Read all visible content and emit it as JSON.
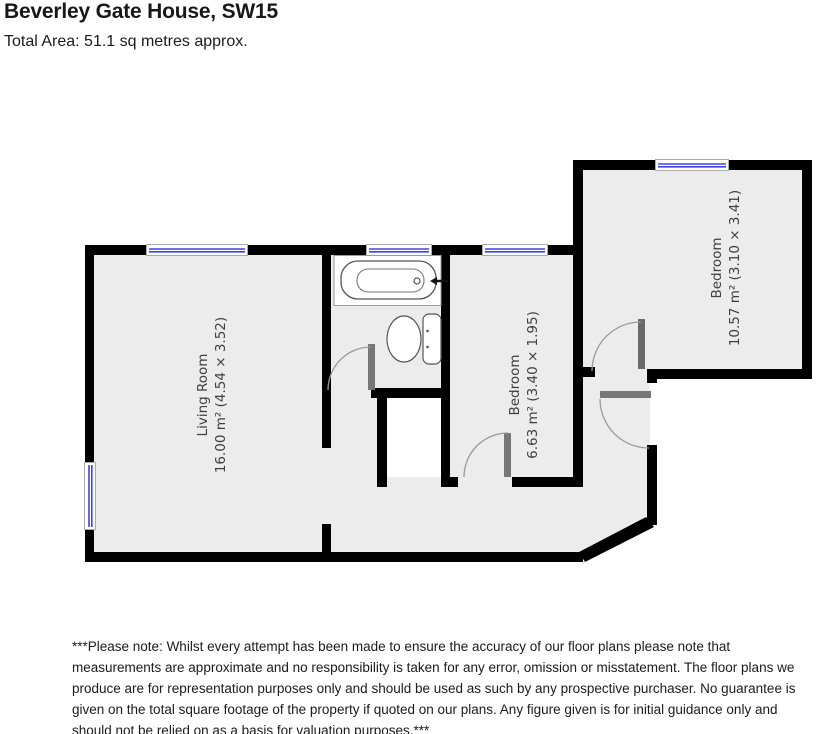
{
  "header": {
    "title": "Beverley Gate House, SW15",
    "subtitle": "Total Area: 51.1 sq metres approx."
  },
  "plan": {
    "rooms": [
      {
        "name": "Living Room",
        "details": "16.00 m² (4.54 × 3.52)"
      },
      {
        "name": "Bedroom",
        "details": "6.63 m² (3.40 × 1.95)"
      },
      {
        "name": "Bedroom",
        "details": "10.57 m² (3.10 × 3.41)"
      }
    ],
    "fixtures": [
      "bathtub",
      "toilet"
    ],
    "colors": {
      "wall": "#000000",
      "floor": "#ececec",
      "window_blue": "#4242e0",
      "door_gray": "#777777"
    }
  },
  "footer": {
    "disclaimer": "***Please note: Whilst every attempt has been made to ensure the accuracy of our floor plans please note that measurements are approximate and no responsibility is taken for any error, omission or misstatement. The floor plans we produce are for representation purposes only and should be used as such by any prospective purchaser. No guarantee is given on the total square footage of the property if quoted on our plans. Any figure given is for initial guidance only and should not be relied on as a basis for valuation purposes.***"
  }
}
